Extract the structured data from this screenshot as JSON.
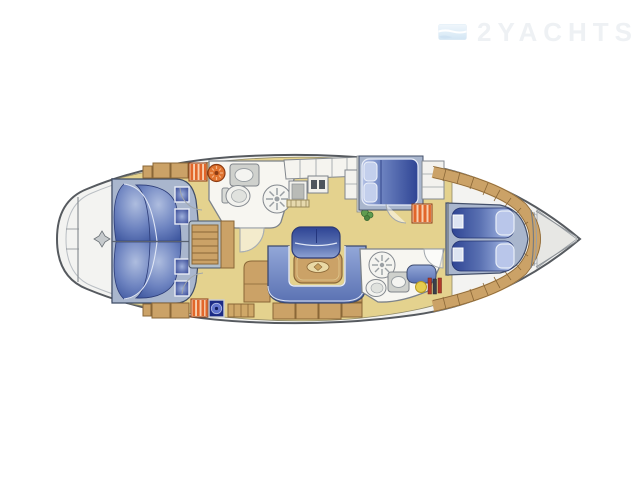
{
  "logo": {
    "text": "2YACHTS",
    "icon": "wave-flag-icon"
  },
  "palette": {
    "bg": "#ffffff",
    "hull": "#f3f3f1",
    "bowfill": "#e7e7e4",
    "hullstroke": "#565a5f",
    "floor": "#e4d28e",
    "wood": "#cba267",
    "wooddark": "#8a6737",
    "whitefloor": "#f7f6f1",
    "wall": "#7d838a",
    "fixture": "#cfd1cd",
    "frameblue": "#a9b6cd",
    "navy": "#1b2b85",
    "stripeorange": "#e2662a",
    "stripelight": "#f7cfae",
    "winch": "#e0732f",
    "yellowdot": "#e6cd4f",
    "plant": "#5f9c4f",
    "logotext": "#eef1f4",
    "cushion_dark": "#2e4494",
    "cushion_mid": "#5a71b2",
    "cushion_light": "#b7c4e6"
  },
  "plan": {
    "type": "sailing-yacht-interior-layout-top-view",
    "bow_direction": "right",
    "stern_direction": "left",
    "areas": [
      {
        "id": "stern-platform",
        "features": [
          "transom-lines",
          "deck-fitting-diamond"
        ]
      },
      {
        "id": "aft-cabin-port",
        "features": [
          "double-berth-scalloped",
          "pillow-squares",
          "wood-lockers",
          "striped-dresser",
          "round-winch-fixture"
        ]
      },
      {
        "id": "aft-cabin-starboard",
        "features": [
          "double-berth-scalloped",
          "pillow-squares",
          "wood-lockers",
          "striped-dresser",
          "compass-instrument"
        ]
      },
      {
        "id": "companionway",
        "features": [
          "wood-steps",
          "gray-frame",
          "entry-door-arcs"
        ]
      },
      {
        "id": "aft-head-port",
        "features": [
          "washbasin-counter",
          "toilet",
          "shower-fan-circle",
          "door-arc"
        ]
      },
      {
        "id": "galley-port",
        "features": [
          "counter-lockers",
          "oven",
          "double-sink",
          "locker-column",
          "plant"
        ]
      },
      {
        "id": "salon",
        "features": [
          "u-shaped-settee",
          "dining-table-with-inlay",
          "bench-seat",
          "nav-desk",
          "floor-lockers",
          "hatched-grate"
        ]
      },
      {
        "id": "pullman-cabin-port",
        "features": [
          "double-berth",
          "pillows",
          "striped-dresser",
          "door-arc",
          "shelf-locker"
        ]
      },
      {
        "id": "forward-head-starboard",
        "features": [
          "shower-fan-circle",
          "toilet",
          "washbasin-unit",
          "blue-cabinet",
          "yellow-stool",
          "toiletry-bars",
          "door-arc"
        ]
      },
      {
        "id": "forward-cabin",
        "features": [
          "v-berth-twin-mattresses",
          "pillows",
          "foot-cushions",
          "wood-shelf-band"
        ]
      },
      {
        "id": "bow",
        "features": [
          "anchor-locker",
          "converging-toe-rails"
        ]
      }
    ]
  }
}
